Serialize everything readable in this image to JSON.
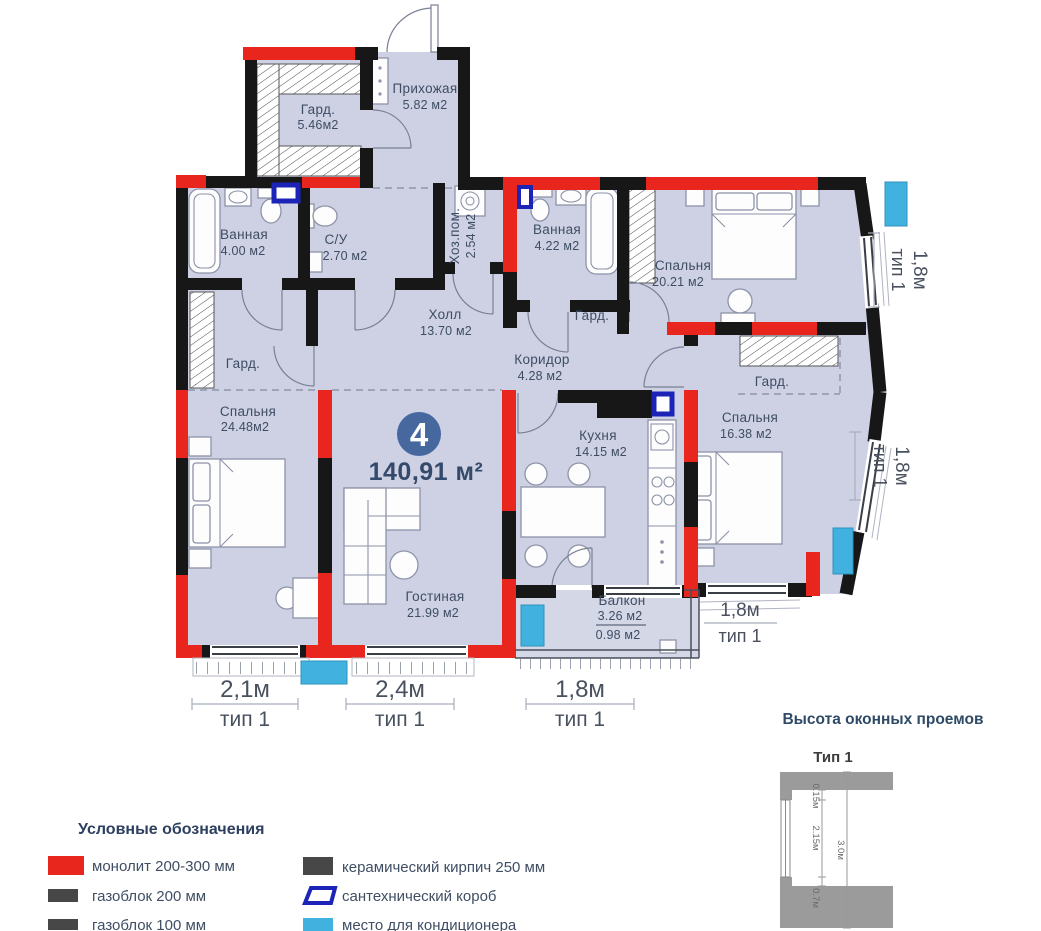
{
  "plan": {
    "badge": {
      "number": "4",
      "total_area": "140,91 м²"
    },
    "rooms": {
      "gard_top": {
        "name": "Гард.",
        "area": "5.46м2"
      },
      "prihozhaya": {
        "name": "Прихожая",
        "area": "5.82 м2"
      },
      "vannaya1": {
        "name": "Ванная",
        "area": "4.00 м2"
      },
      "su": {
        "name": "С/У",
        "area": "2.70 м2"
      },
      "hozpom": {
        "name": "Хоз.пом.",
        "area": "2.54 м2"
      },
      "vannaya2": {
        "name": "Ванная",
        "area": "4.22 м2"
      },
      "spalnya1": {
        "name": "Спальня",
        "area": "20.21 м2"
      },
      "gard1": {
        "name": "Гард."
      },
      "holl": {
        "name": "Холл",
        "area": "13.70 м2"
      },
      "koridor": {
        "name": "Коридор",
        "area": "4.28 м2"
      },
      "gard_left": {
        "name": "Гард."
      },
      "gard2": {
        "name": "Гард."
      },
      "spalnya2": {
        "name": "Спальня",
        "area": "24.48м2"
      },
      "spalnya3": {
        "name": "Спальня",
        "area": "16.38 м2"
      },
      "kuhnya": {
        "name": "Кухня",
        "area": "14.15 м2"
      },
      "gostinaya": {
        "name": "Гостиная",
        "area": "21.99 м2"
      },
      "balkon": {
        "name": "Балкон",
        "area": "3.26 м2",
        "area2": "0.98 м2"
      }
    },
    "dims": {
      "bottom": [
        {
          "size": "2,1м",
          "type": "тип 1"
        },
        {
          "size": "2,4м",
          "type": "тип 1"
        },
        {
          "size": "1,8м",
          "type": "тип 1"
        }
      ],
      "balcony": {
        "size": "1,8м",
        "type": "тип 1"
      },
      "right": [
        {
          "size": "1,8м",
          "type": "тип 1"
        },
        {
          "size": "1,8м",
          "type": "тип 1"
        }
      ]
    }
  },
  "legend": {
    "title": "Условные обозначения",
    "items": [
      {
        "label": "монолит 200-300 мм",
        "color": "#e8261e",
        "symbol": "monolith-swatch"
      },
      {
        "label": "газоблок 200 мм",
        "color": "#474747",
        "symbol": "gasblock200-swatch"
      },
      {
        "label": "газоблок 100 мм",
        "color": "#474747",
        "symbol": "gasblock100-swatch"
      },
      {
        "label": "керамический кирпич 250 мм",
        "color": "#474747",
        "symbol": "ceramic-brick-swatch"
      },
      {
        "label": "сантехнический короб",
        "color": "#1c24b8",
        "symbol": "sanitary-box-swatch"
      },
      {
        "label": "место для кондиционера",
        "color": "#41b2e0",
        "symbol": "ac-place-swatch"
      }
    ]
  },
  "window_heights": {
    "title": "Высота оконных проемов",
    "type_label": "Тип 1",
    "m": [
      "0.15м",
      "2.15м",
      "0.7м",
      "3.0м"
    ]
  },
  "colors": {
    "floor": "#cdd1e3",
    "wall_red": "#e8261e",
    "wall_black": "#171717",
    "ac_blue": "#41b2e0",
    "sanitary_navy": "#1c24b8",
    "badge_blue": "#47689f"
  }
}
